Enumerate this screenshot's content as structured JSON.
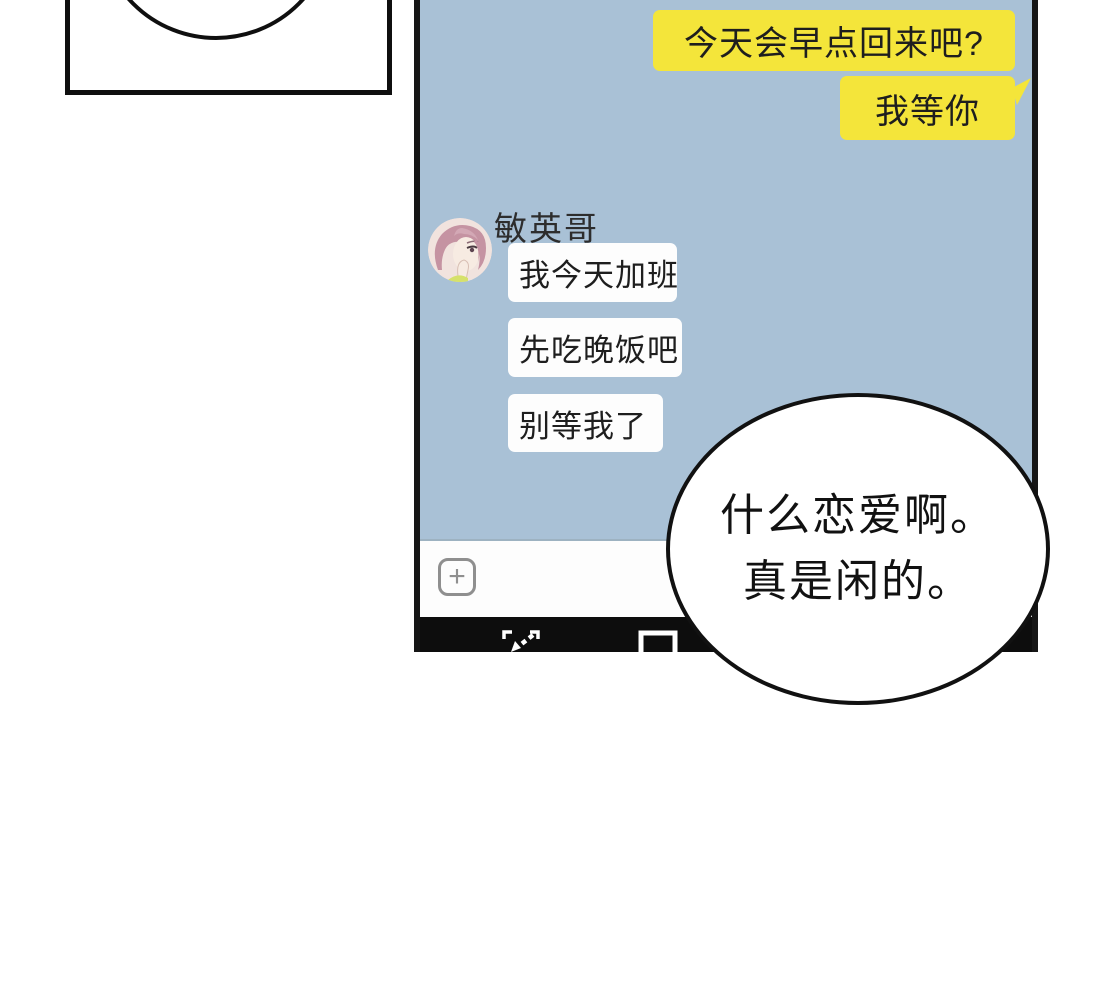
{
  "colors": {
    "page_background": "#ffffff",
    "chat_background": "#a9c1d6",
    "outgoing_bubble": "#f4e53a",
    "incoming_bubble": "#fdfdfd",
    "phone_frame": "#161616",
    "nav_bar": "#0d0d0d",
    "text_dark": "#1e1e1e"
  },
  "phone": {
    "chat": {
      "outgoing_messages": [
        "今天会早点回来吧?",
        "我等你"
      ],
      "sender_name": "敏英哥",
      "incoming_messages": [
        "我今天加班",
        "先吃晚饭吧",
        "别等我了"
      ]
    },
    "input_bar": {
      "plus_glyph": "+"
    }
  },
  "speech_balloon": {
    "lines": [
      "什么恋爱啊。",
      "真是闲的。"
    ]
  }
}
